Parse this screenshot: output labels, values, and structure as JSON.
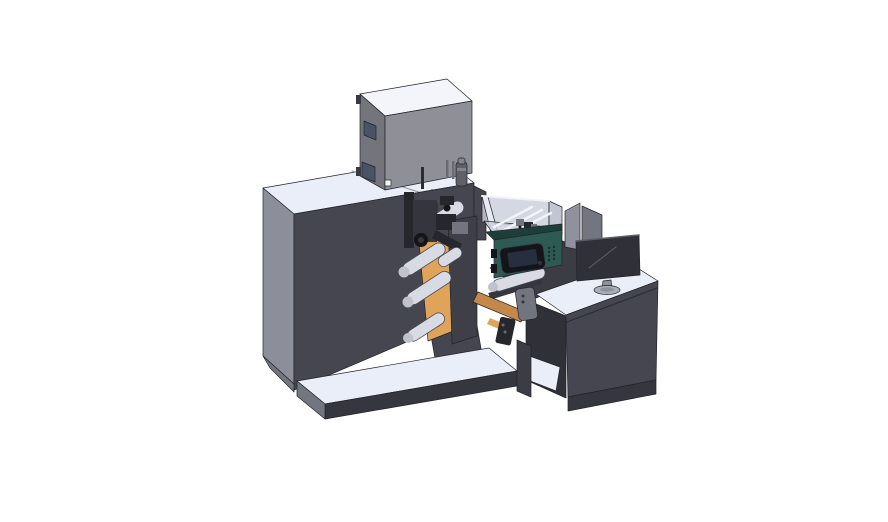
{
  "scene": {
    "type": "3d-cad-render",
    "description": "Isometric CAD rendering of a label printing / inspection machine line with operator desk and monitor on white background",
    "parts": [
      "machine-body",
      "base-plate",
      "printer-housing",
      "supply-bottle",
      "web-guide-plate",
      "label-web",
      "guide-rollers",
      "print-mechanism",
      "inspection-enclosure",
      "controller-panel",
      "touchscreen",
      "output-shelf",
      "conveyor-belt",
      "sensor-device",
      "operator-desk",
      "divider-screen",
      "desktop-monitor"
    ]
  },
  "palette": {
    "bg": "#ffffff",
    "top_light": "#eaeef8",
    "top_light2": "#f3f5fa",
    "side_gray": "#8c8f99",
    "side_gray_dark": "#73767f",
    "body_dark": "#45464f",
    "body_darker": "#35363e",
    "plate_dark": "#3e3f47",
    "box_front": "#8f9097",
    "box_left": "#74757c",
    "window_dark": "#4a5366",
    "slot_gray": "#6b6c72",
    "white_detail": "#f5f6f8",
    "bottle_gray": "#5f6068",
    "bottle_band": "#84858c",
    "roller_light": "#d8dbe3",
    "roller_cap": "#bfc3cd",
    "orange": "#dfa35a",
    "orange_dark": "#c4884a",
    "teal": "#2d5a52",
    "teal_dark": "#1d3f39",
    "teal_vent": "#16332e",
    "screen_bezel": "#141519",
    "screen_blue": "#262e40",
    "acrylic": "#c9cfdc",
    "acrylic_dark": "#b4bac8",
    "acrylic_light": "#e6eaf2",
    "rail_white": "#f2f4f8",
    "pink": "#c468cf",
    "monitor_dark": "#303138",
    "monitor_edge": "#5d5f67",
    "stand_gray": "#8f929c",
    "base_gray": "#a9aeb9",
    "shelf_dark": "#3b3c44",
    "interior_dark": "#2f3038",
    "device_gray": "#73757e",
    "mech_dark": "#26272c",
    "mech_mid": "#35363d",
    "mech_black": "#141518",
    "seam": "#8a8f9a",
    "seam_dark": "#2c2d34",
    "hinge_dark": "#3a3b42",
    "rod_dark": "#2b2c32"
  }
}
